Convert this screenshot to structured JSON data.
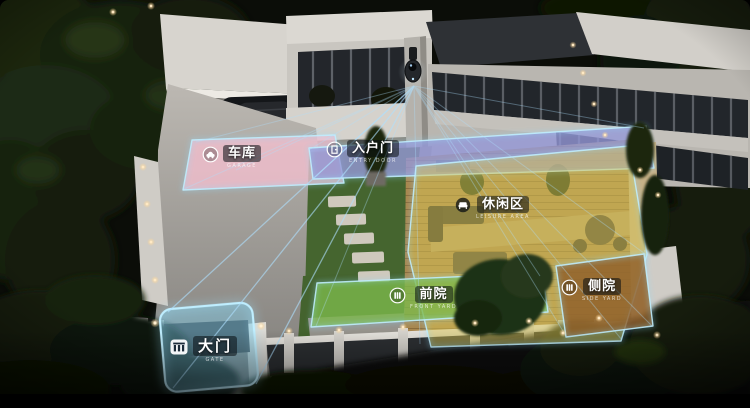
{
  "scene": {
    "description_zones_note": "smart-home yard camera coverage map",
    "zones": [
      {
        "id": "garage",
        "label": "车库",
        "subtext": "GARAGE",
        "icon": "car-icon",
        "color": "#f3bfce"
      },
      {
        "id": "entry-door",
        "label": "入户门",
        "subtext": "ENTRY DOOR",
        "icon": "door-icon",
        "color": "#9599d8"
      },
      {
        "id": "leisure-area",
        "label": "休闲区",
        "subtext": "LEISURE AREA",
        "icon": "sofa-icon",
        "color": "#d8c554"
      },
      {
        "id": "front-yard",
        "label": "前院",
        "subtext": "FRONT YARD",
        "icon": "fence-icon",
        "color": "#7cba4b"
      },
      {
        "id": "side-yard",
        "label": "侧院",
        "subtext": "SIDE YARD",
        "icon": "fence-icon",
        "color": "#8f5f2b"
      },
      {
        "id": "gate",
        "label": "大门",
        "subtext": "GATE",
        "icon": "gate-icon",
        "color": "#7ccdea"
      }
    ],
    "camera": {
      "id": "security-camera",
      "beam_color": "#aadcff"
    },
    "zone_border_color": "#bfeeff"
  }
}
